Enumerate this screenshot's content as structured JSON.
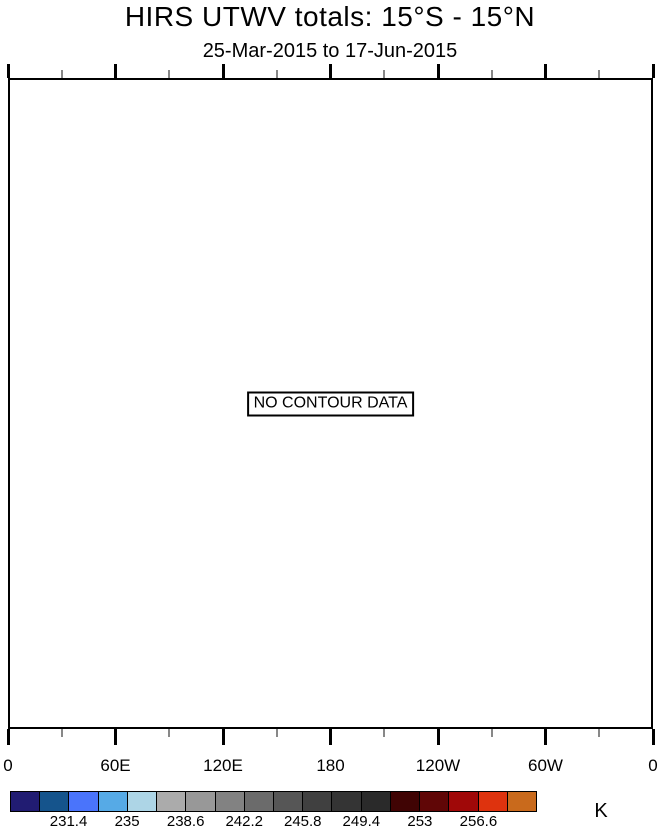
{
  "figure": {
    "title": "HIRS UTWV totals: 15°S - 15°N",
    "subtitle": "25-Mar-2015 to 17-Jun-2015"
  },
  "plot": {
    "no_data_label": "NO CONTOUR DATA",
    "x_axis": {
      "major_labels": [
        "0",
        "60E",
        "120E",
        "180",
        "120W",
        "60W",
        "0"
      ]
    }
  },
  "colorbar": {
    "unit": "K",
    "colors": [
      "#211C72",
      "#15548C",
      "#4A74FB",
      "#56AAE6",
      "#ADD5E6",
      "#ABABAB",
      "#989898",
      "#828282",
      "#6B6B6B",
      "#565656",
      "#404040",
      "#343434",
      "#2A2A2A",
      "#400404",
      "#600606",
      "#A00808",
      "#DE330E",
      "#C96A1C"
    ],
    "tick_labels": [
      "231.4",
      "235",
      "238.6",
      "242.2",
      "245.8",
      "249.4",
      "253",
      "256.6"
    ]
  },
  "chart_data": {
    "type": "heatmap",
    "title": "HIRS UTWV totals: 15°S - 15°N",
    "subtitle": "25-Mar-2015 to 17-Jun-2015",
    "status": "NO CONTOUR DATA",
    "values": [],
    "x_tick_labels": [
      "0",
      "60E",
      "120E",
      "180",
      "120W",
      "60W",
      "0"
    ],
    "grid": false,
    "colorbar": {
      "unit": "K",
      "labeled_levels": [
        231.4,
        235,
        238.6,
        242.2,
        245.8,
        249.4,
        253,
        256.6
      ],
      "n_colors": 18,
      "colors": [
        "#211C72",
        "#15548C",
        "#4A74FB",
        "#56AAE6",
        "#ADD5E6",
        "#ABABAB",
        "#989898",
        "#828282",
        "#6B6B6B",
        "#565656",
        "#404040",
        "#343434",
        "#2A2A2A",
        "#400404",
        "#600606",
        "#A00808",
        "#DE330E",
        "#C96A1C"
      ]
    }
  }
}
